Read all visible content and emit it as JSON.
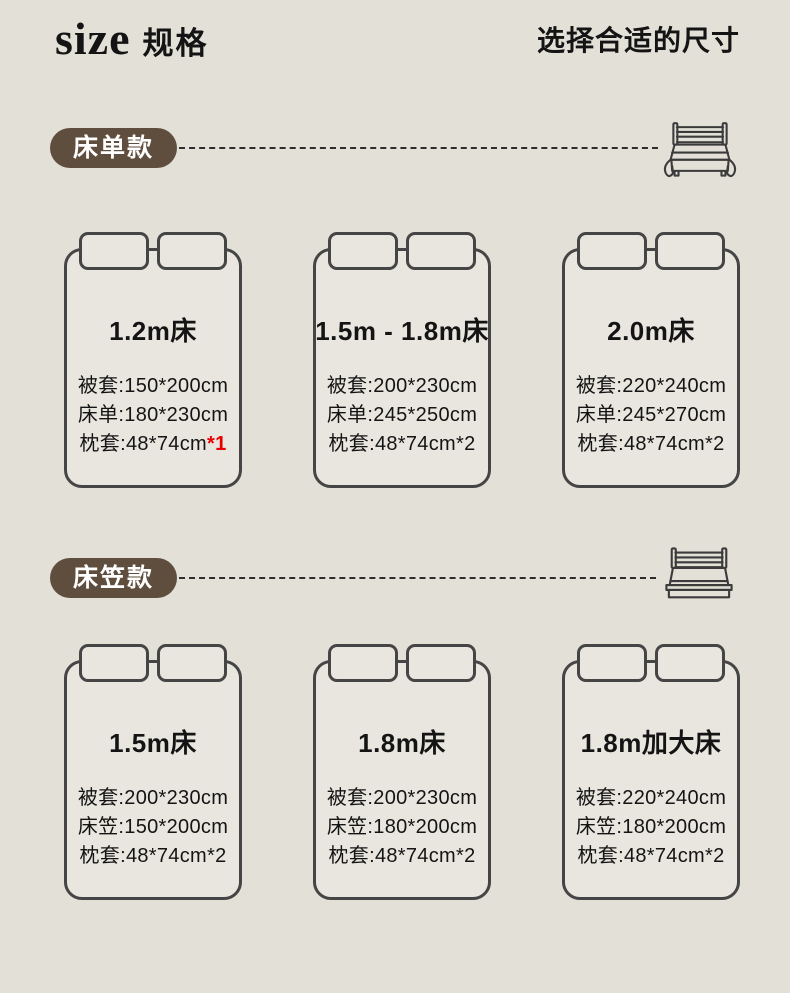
{
  "header": {
    "title_en": "size",
    "title_zh": "规格",
    "subtitle": "选择合适的尺寸"
  },
  "colors": {
    "background": "#e2e0d7",
    "card_fill": "#e8e6de",
    "line": "#454545",
    "pill": "#5f4e3d",
    "text": "#141414",
    "red": "#e80000"
  },
  "sections": [
    {
      "label": "床单款",
      "icon": "draped-sheet-bed-icon",
      "cards": [
        {
          "title": "1.2m床",
          "specs": [
            {
              "text": "被套:150*200cm"
            },
            {
              "text": "床单:180*230cm"
            },
            {
              "text": "枕套:48*74cm",
              "red": "*1"
            }
          ]
        },
        {
          "title": "1.5m - 1.8m床",
          "specs": [
            {
              "text": "被套:200*230cm"
            },
            {
              "text": "床单:245*250cm"
            },
            {
              "text": "枕套:48*74cm*2"
            }
          ]
        },
        {
          "title": "2.0m床",
          "specs": [
            {
              "text": "被套:220*240cm"
            },
            {
              "text": "床单:245*270cm"
            },
            {
              "text": "枕套:48*74cm*2"
            }
          ]
        }
      ]
    },
    {
      "label": "床笠款",
      "icon": "fitted-sheet-bed-icon",
      "cards": [
        {
          "title": "1.5m床",
          "specs": [
            {
              "text": "被套:200*230cm"
            },
            {
              "text": "床笠:150*200cm"
            },
            {
              "text": "枕套:48*74cm*2"
            }
          ]
        },
        {
          "title": "1.8m床",
          "specs": [
            {
              "text": "被套:200*230cm"
            },
            {
              "text": "床笠:180*200cm"
            },
            {
              "text": "枕套:48*74cm*2"
            }
          ]
        },
        {
          "title": "1.8m加大床",
          "specs": [
            {
              "text": "被套:220*240cm"
            },
            {
              "text": "床笠:180*200cm"
            },
            {
              "text": "枕套:48*74cm*2"
            }
          ]
        }
      ]
    }
  ]
}
